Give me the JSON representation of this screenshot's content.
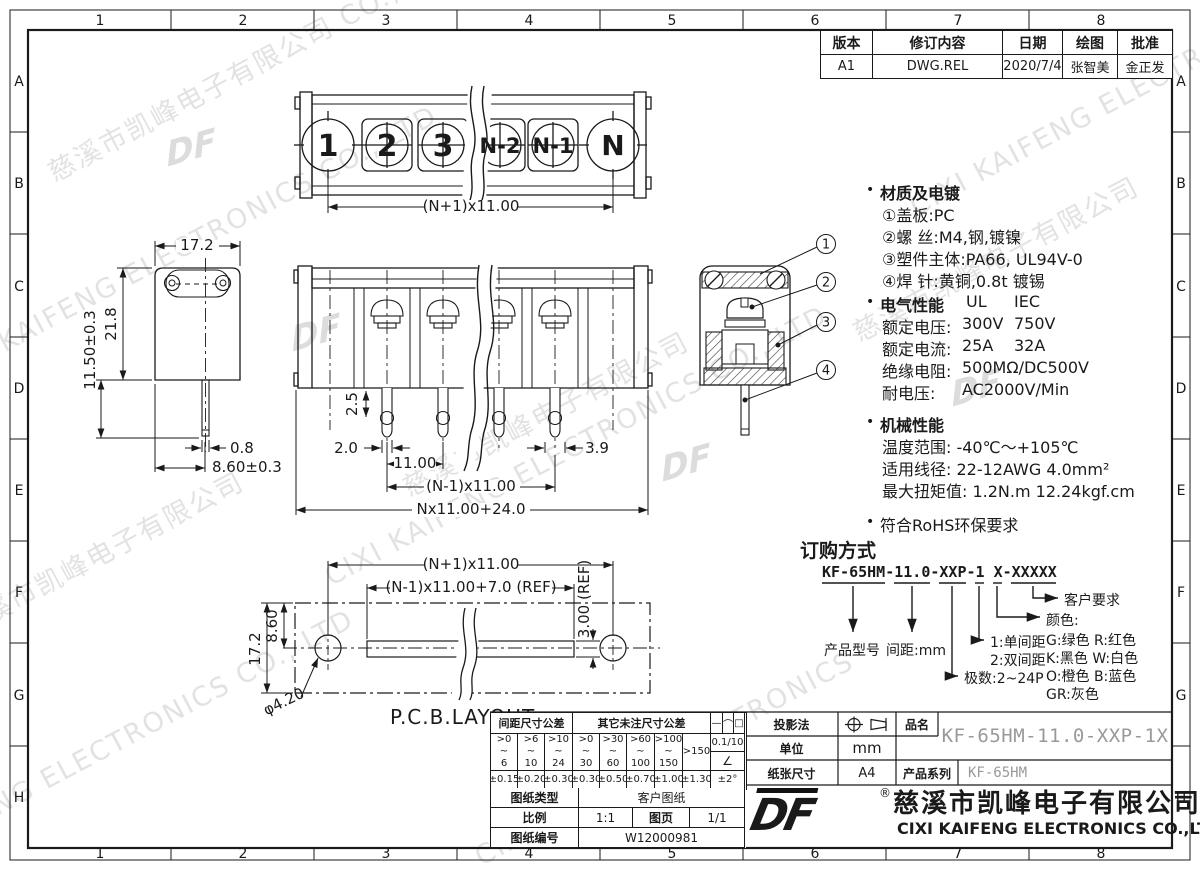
{
  "sheet": {
    "paper_color": "#ffffff",
    "line_color": "#1a1a1a",
    "draft_gray": "#999999",
    "watermark_gray": "#cccccc"
  },
  "zones": {
    "cols": [
      "1",
      "2",
      "3",
      "4",
      "5",
      "6",
      "7",
      "8"
    ],
    "rows": [
      "A",
      "B",
      "C",
      "D",
      "E",
      "F",
      "G",
      "H"
    ]
  },
  "revision": {
    "headers": [
      "版本",
      "修订内容",
      "日期",
      "绘图",
      "批准"
    ],
    "values": [
      "A1",
      "DWG.REL",
      "2020/7/4",
      "张智美",
      "金正发"
    ]
  },
  "notes": {
    "bullet": "•",
    "material": {
      "title": "材质及电镀",
      "items": [
        "①盖板:PC",
        "②螺 丝:M4,钢,镀镍",
        "③塑件主体:PA66, UL94V-0",
        "④焊 针:黄铜,0.8t 镀锡"
      ]
    },
    "electrical": {
      "title": "电气性能",
      "col1": "UL",
      "col2": "IEC",
      "rows": [
        {
          "l": "额定电压:",
          "a": "300V",
          "b": "750V"
        },
        {
          "l": "额定电流:",
          "a": "25A",
          "b": "32A"
        },
        {
          "l": "绝缘电阻:",
          "a": "500MΩ/DC500V",
          "b": ""
        },
        {
          "l": "耐电压:",
          "a": "AC2000V/Min",
          "b": ""
        }
      ]
    },
    "mechanical": {
      "title": "机械性能",
      "items": [
        "温度范围: -40℃～+105℃",
        "适用线径: 22-12AWG 4.0mm²",
        "最大扭矩值: 1.2N.m 12.24kgf.cm"
      ]
    },
    "rohs": "符合RoHS环保要求"
  },
  "ordering": {
    "title": "订购方式",
    "code": "KF-65HM-11.0-XXP-1 X-XXXXX",
    "model": "产品型号",
    "pitch": "间距:mm",
    "single": "1:单间距",
    "double": "2:双间距",
    "poles": "极数:2~24P",
    "color_title": "颜色:",
    "colors": [
      "G:绿色  R:红色",
      "K:黑色  W:白色",
      "O:橙色  B:蓝色",
      "GR:灰色"
    ],
    "customer": "客户要求"
  },
  "views": {
    "top": {
      "terminals": [
        "1",
        "2",
        "3",
        "N-2",
        "N-1",
        "N"
      ],
      "dim_pitch": "(N+1)x11.00"
    },
    "front": {
      "dim_25": "2.5",
      "dim_20": "2.0",
      "dim_11": "11.00",
      "dim_span": "(N-1)x11.00",
      "dim_total": "Nx11.00+24.0",
      "dim_39": "3.9"
    },
    "side": {
      "dim_w": "17.2",
      "dim_h": "21.8",
      "dim_pin_len": "11.50±0.3",
      "dim_pin_w": "0.8",
      "dim_pin_pos": "8.60±0.3"
    },
    "section": {
      "callouts": [
        "1",
        "2",
        "3",
        "4"
      ]
    },
    "pcb": {
      "label": "P.C.B.LAYOUT",
      "dim_pitch": "(N+1)x11.00",
      "dim_slot": "(N-1)x11.00+7.0 (REF)",
      "dim_slot_w": "3.00 (REF)",
      "dim_h": "17.2",
      "dim_half": "8.60",
      "dim_hole": "φ4.20"
    }
  },
  "tolerance": {
    "pitch_header": "间距尺寸公差",
    "other_header": "其它未注尺寸公差",
    "pitch_ranges": [
      ">0\n~\n6",
      ">6\n~\n10",
      ">10\n~\n24"
    ],
    "pitch_tols": [
      "±0.15",
      "±0.20",
      "±0.30"
    ],
    "other_ranges": [
      ">0\n~\n30",
      ">30\n~\n60",
      ">60\n~\n100",
      ">100\n~\n150",
      ">150"
    ],
    "other_tols": [
      "±0.30",
      "±0.50",
      "±0.70",
      "±1.00",
      "±1.30"
    ],
    "sym_flat": "—",
    "sym_arc": "⌒",
    "sym_square": "□",
    "taper": "0.1/10",
    "angle_sym": "∠",
    "angle_tol": "±2°"
  },
  "titleblock": {
    "proj_label": "投影法",
    "unit_label": "单位",
    "unit": "mm",
    "paper_label": "纸张尺寸",
    "paper": "A4",
    "name_label": "品名",
    "name": "KF-65HM-11.0-XXP-1X",
    "series_label": "产品系列",
    "series": "KF-65HM",
    "type_label": "图纸类型",
    "type": "客户图纸",
    "scale_label": "比例",
    "scale": "1:1",
    "page_label": "图页",
    "page": "1/1",
    "no_label": "图纸编号",
    "no": "W12000981"
  },
  "company": {
    "logo": "DF",
    "reg": "®",
    "cn": "慈溪市凯峰电子有限公司",
    "en": "CIXI KAIFENG ELECTRONICS CO.,LTD"
  },
  "watermarks": [
    "慈溪市凯峰电子有限公司 CO., LTD",
    "CIXI KAIFENG ELECTRONICS CO., LTD",
    "慈溪市凯峰电子有限公司",
    "KAIFENG ELECTRONICS CO., LTD",
    "CIXI KAIFENG ELECTRONICS CO., LTD",
    "慈溪市凯峰电子有限公司",
    "CIXI KAIFENG ELECTRONICS CO., LTD",
    "慈溪市凯峰电子有限公司",
    "CIXI KAIFENG ELECTRONICS"
  ]
}
